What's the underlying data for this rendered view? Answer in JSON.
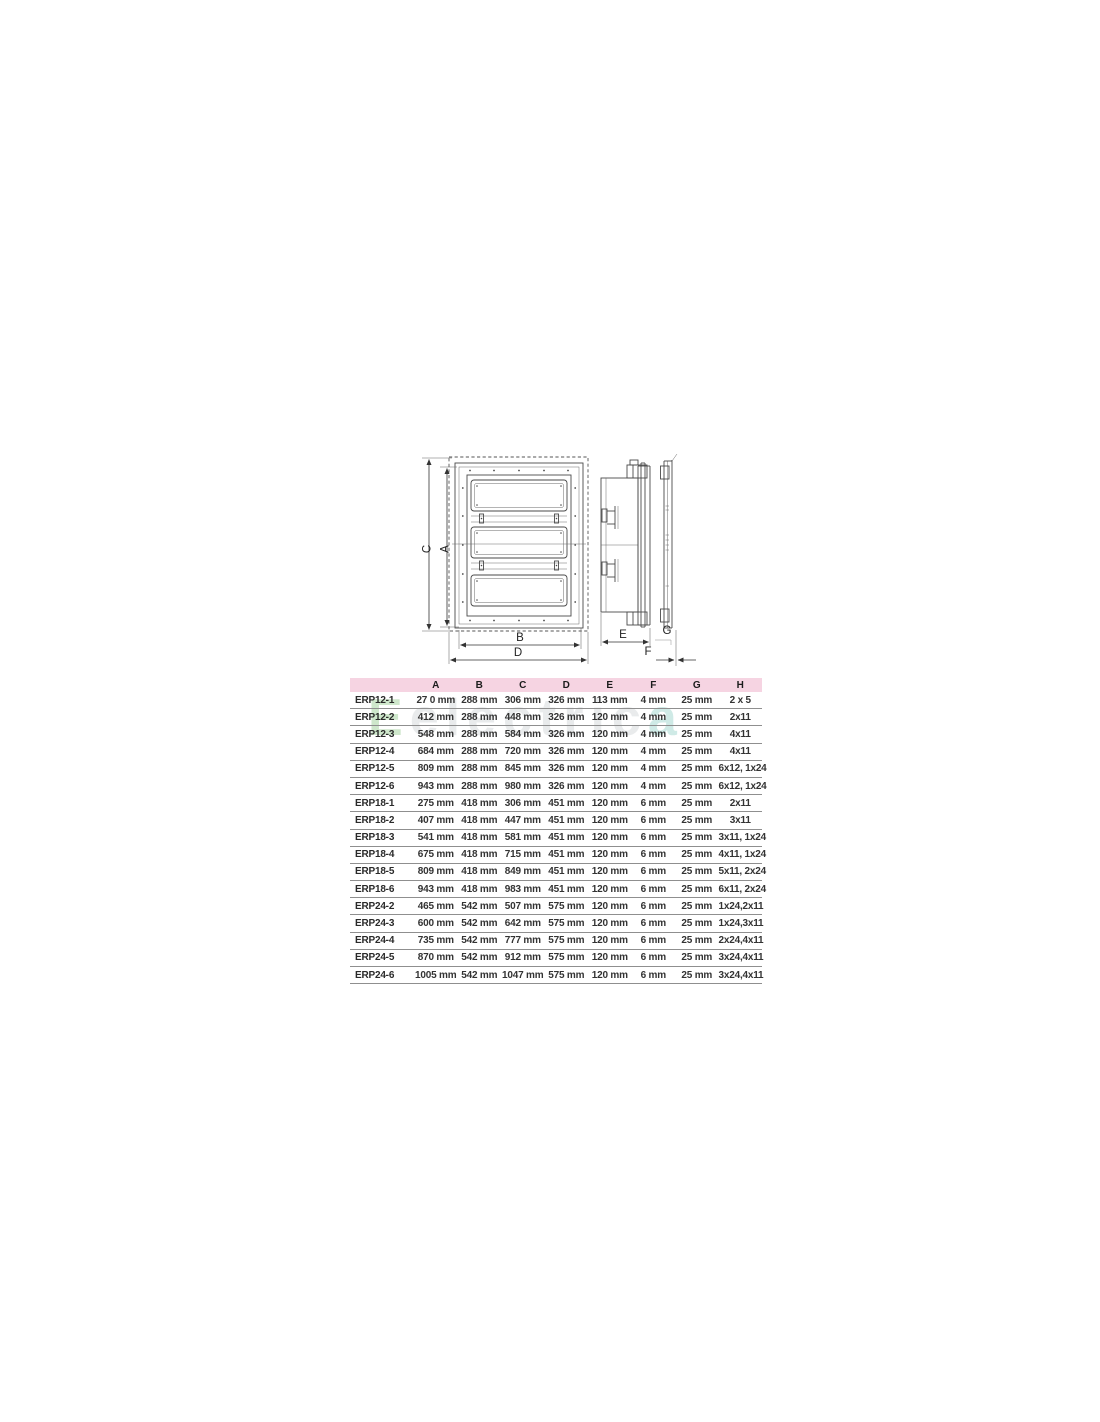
{
  "page": {
    "background": "#ffffff"
  },
  "drawing": {
    "dim_labels": {
      "C": "C",
      "A": "A",
      "B": "B",
      "D": "D",
      "E": "E",
      "F": "F",
      "G": "G"
    }
  },
  "watermark": {
    "part1": "E",
    "part2": "electric",
    "part3": "a",
    "color1": "#8cc785",
    "color2": "#ccd1d4",
    "color3": "#8fcec4"
  },
  "table": {
    "header_bg": "#f6d4e2",
    "headers": [
      "",
      "A",
      "B",
      "C",
      "D",
      "E",
      "F",
      "G",
      "H"
    ],
    "rows": [
      {
        "model": "ERP12-1",
        "values": [
          "27 0 mm",
          "288 mm",
          "306 mm",
          "326 mm",
          "113 mm",
          "4 mm",
          "25 mm",
          "2 x 5"
        ]
      },
      {
        "model": "ERP12-2",
        "values": [
          "412 mm",
          "288 mm",
          "448 mm",
          "326 mm",
          "120 mm",
          "4 mm",
          "25 mm",
          "2x11"
        ]
      },
      {
        "model": "ERP12-3",
        "values": [
          "548 mm",
          "288 mm",
          "584 mm",
          "326 mm",
          "120 mm",
          "4 mm",
          "25 mm",
          "4x11"
        ]
      },
      {
        "model": "ERP12-4",
        "values": [
          "684 mm",
          "288 mm",
          "720 mm",
          "326 mm",
          "120 mm",
          "4 mm",
          "25 mm",
          "4x11"
        ]
      },
      {
        "model": "ERP12-5",
        "values": [
          "809 mm",
          "288 mm",
          "845 mm",
          "326 mm",
          "120 mm",
          "4 mm",
          "25 mm",
          "6x12, 1x24"
        ]
      },
      {
        "model": "ERP12-6",
        "values": [
          "943 mm",
          "288 mm",
          "980 mm",
          "326 mm",
          "120 mm",
          "4 mm",
          "25 mm",
          "6x12, 1x24"
        ]
      },
      {
        "model": "ERP18-1",
        "values": [
          "275 mm",
          "418 mm",
          "306 mm",
          "451 mm",
          "120 mm",
          "6 mm",
          "25 mm",
          "2x11"
        ]
      },
      {
        "model": "ERP18-2",
        "values": [
          "407 mm",
          "418 mm",
          "447 mm",
          "451 mm",
          "120 mm",
          "6 mm",
          "25 mm",
          "3x11"
        ]
      },
      {
        "model": "ERP18-3",
        "values": [
          "541 mm",
          "418 mm",
          "581 mm",
          "451 mm",
          "120 mm",
          "6 mm",
          "25 mm",
          "3x11, 1x24"
        ]
      },
      {
        "model": "ERP18-4",
        "values": [
          "675 mm",
          "418 mm",
          "715 mm",
          "451 mm",
          "120 mm",
          "6 mm",
          "25 mm",
          "4x11, 1x24"
        ]
      },
      {
        "model": "ERP18-5",
        "values": [
          "809 mm",
          "418 mm",
          "849 mm",
          "451 mm",
          "120 mm",
          "6 mm",
          "25 mm",
          "5x11, 2x24"
        ]
      },
      {
        "model": "ERP18-6",
        "values": [
          "943 mm",
          "418 mm",
          "983 mm",
          "451 mm",
          "120 mm",
          "6 mm",
          "25 mm",
          "6x11, 2x24"
        ]
      },
      {
        "model": "ERP24-2",
        "values": [
          "465 mm",
          "542 mm",
          "507 mm",
          "575 mm",
          "120 mm",
          "6 mm",
          "25 mm",
          "1x24,2x11"
        ]
      },
      {
        "model": "ERP24-3",
        "values": [
          "600 mm",
          "542 mm",
          "642 mm",
          "575 mm",
          "120 mm",
          "6 mm",
          "25 mm",
          "1x24,3x11"
        ]
      },
      {
        "model": "ERP24-4",
        "values": [
          "735 mm",
          "542 mm",
          "777 mm",
          "575 mm",
          "120 mm",
          "6 mm",
          "25 mm",
          "2x24,4x11"
        ]
      },
      {
        "model": "ERP24-5",
        "values": [
          "870 mm",
          "542 mm",
          "912 mm",
          "575 mm",
          "120 mm",
          "6 mm",
          "25 mm",
          "3x24,4x11"
        ]
      },
      {
        "model": "ERP24-6",
        "values": [
          "1005 mm",
          "542 mm",
          "1047 mm",
          "575 mm",
          "120 mm",
          "6 mm",
          "25 mm",
          "3x24,4x11"
        ]
      }
    ]
  }
}
